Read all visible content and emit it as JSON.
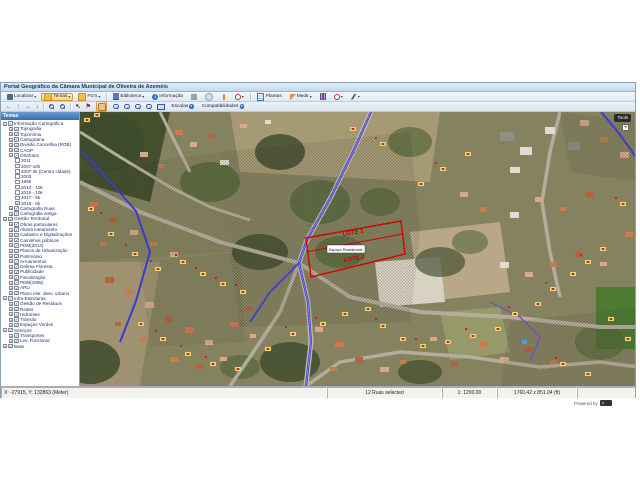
{
  "window": {
    "title": "Portal Geográfico da Câmara Municipal de Oliveira de Azeméis"
  },
  "colors": {
    "titlebar": "#c3d8ee",
    "active_button": "#ffd36e",
    "sidebar_header": "#3a6cb0",
    "parcel_red": "#d40000",
    "route_blue": "#3b3bd0",
    "address_box_yellow": "#f7e98a"
  },
  "toolbar_primary": {
    "items": [
      {
        "name": "localizar-button",
        "label": "Localizar",
        "icon": "binoculars",
        "arrow": true
      },
      {
        "name": "temas-button",
        "label": "Temas",
        "icon": "folder",
        "arrow": true,
        "active": true
      },
      {
        "name": "fgs-button",
        "label": "FG's",
        "icon": "folder",
        "arrow": true
      },
      {
        "name": "sep"
      },
      {
        "name": "biblioteca-button",
        "label": "Biblioteca",
        "icon": "library",
        "arrow": true
      },
      {
        "name": "informacao-button",
        "label": "Informação",
        "icon": "info"
      },
      {
        "name": "print-button",
        "icon": "print"
      },
      {
        "name": "globe-button",
        "icon": "globe"
      },
      {
        "name": "marker-button",
        "icon": "marker"
      },
      {
        "name": "settings-button",
        "icon": "gear-red",
        "arrow": true
      },
      {
        "name": "sep"
      },
      {
        "name": "plantas-button",
        "label": "Plantas",
        "icon": "document"
      },
      {
        "name": "medir-button",
        "label": "Medir",
        "icon": "ruler",
        "arrow": true
      },
      {
        "name": "chart-button",
        "icon": "chart"
      },
      {
        "name": "target-button",
        "icon": "target",
        "arrow": true
      },
      {
        "name": "tools-button",
        "icon": "wrench",
        "arrow": true
      }
    ]
  },
  "toolbar_secondary": {
    "items": [
      {
        "name": "pan-left-button",
        "type": "arrow-left"
      },
      {
        "name": "pan-up-button",
        "type": "arrow-up"
      },
      {
        "name": "pan-right-button",
        "type": "arrow-right"
      },
      {
        "name": "pan-down-button",
        "type": "arrow-down"
      },
      {
        "name": "sep",
        "type": "sep"
      },
      {
        "name": "zoom-in-button",
        "type": "zoom-plus"
      },
      {
        "name": "zoom-out-button",
        "type": "zoom-minus"
      },
      {
        "name": "sep",
        "type": "sep"
      },
      {
        "name": "select-pointer-button",
        "type": "pointer"
      },
      {
        "name": "flag-button",
        "type": "flag"
      },
      {
        "name": "pan-hand-button",
        "type": "hand",
        "active": true
      },
      {
        "name": "zoom-window-button",
        "type": "zoom"
      },
      {
        "name": "zoom-selection-button",
        "type": "zoom"
      },
      {
        "name": "zoom-previous-button",
        "type": "zoom"
      },
      {
        "name": "zoom-next-button",
        "type": "zoom"
      },
      {
        "name": "full-extent-button",
        "type": "extent"
      },
      {
        "name": "escalas-button",
        "type": "btn",
        "label": "Escalas"
      },
      {
        "name": "compatibilidades-button",
        "type": "btn",
        "label": "Compatibilidades"
      }
    ]
  },
  "sidebar": {
    "header": "Temas",
    "items": [
      {
        "l": "Informação Cartográfica",
        "d": 0,
        "e": "-",
        "c": true
      },
      {
        "l": "Topografia",
        "d": 1,
        "e": "+",
        "c": true
      },
      {
        "l": "Toponímia",
        "d": 1,
        "e": "+",
        "c": true
      },
      {
        "l": "Cartograma",
        "d": 1,
        "e": "+",
        "c": true
      },
      {
        "l": "Divisão Concelhia (ROB)",
        "d": 1,
        "e": "+",
        "c": true
      },
      {
        "l": "CAOP",
        "d": 1,
        "e": "+",
        "c": true
      },
      {
        "l": "Ortofotos",
        "d": 1,
        "e": "-",
        "c": true
      },
      {
        "l": "2011",
        "d": 2,
        "e": "",
        "c": false
      },
      {
        "l": "2007-10k",
        "d": 2,
        "e": "",
        "c": false
      },
      {
        "l": "2007-2k (Centro cidade)",
        "d": 2,
        "e": "",
        "c": false
      },
      {
        "l": "2003",
        "d": 2,
        "e": "",
        "c": false
      },
      {
        "l": "1995",
        "d": 2,
        "e": "",
        "c": false
      },
      {
        "l": "2012 - 10k",
        "d": 2,
        "e": "",
        "c": false
      },
      {
        "l": "2015 - 10k",
        "d": 2,
        "e": "",
        "c": false
      },
      {
        "l": "2017 - 5k",
        "d": 2,
        "e": "",
        "c": false
      },
      {
        "l": "2018 - 5k",
        "d": 2,
        "e": "",
        "c": true
      },
      {
        "l": "Cartografia Ruas",
        "d": 1,
        "e": "+",
        "c": true
      },
      {
        "l": "Cartografia antiga",
        "d": 1,
        "e": "+",
        "c": true
      },
      {
        "l": "Gestão Territorial",
        "d": 0,
        "e": "-",
        "c": true
      },
      {
        "l": "Obras particulares",
        "d": 1,
        "e": "+",
        "c": true
      },
      {
        "l": "Alvará loteamento",
        "d": 1,
        "e": "+",
        "c": true
      },
      {
        "l": "Cadastro e Digitalizações",
        "d": 1,
        "e": "+",
        "c": true
      },
      {
        "l": "Caminhos públicos",
        "d": 1,
        "e": "+",
        "c": true
      },
      {
        "l": "PDM(2013)",
        "d": 1,
        "e": "+",
        "c": true
      },
      {
        "l": "Planos de Urbanização",
        "d": 1,
        "e": "+",
        "c": true
      },
      {
        "l": "Património",
        "d": 1,
        "e": "+",
        "c": true
      },
      {
        "l": "Arruamentos",
        "d": 1,
        "e": "+",
        "c": true
      },
      {
        "l": "Defesa Floresta",
        "d": 1,
        "e": "+",
        "c": true
      },
      {
        "l": "Publicidade",
        "d": 1,
        "e": "+",
        "c": true
      },
      {
        "l": "Fiscalização",
        "d": 1,
        "e": "+",
        "c": true
      },
      {
        "l": "PDM(1995)",
        "d": 1,
        "e": "+",
        "c": true
      },
      {
        "l": "ARU",
        "d": 1,
        "e": "+",
        "c": true
      },
      {
        "l": "Plano estr. desv. urbano",
        "d": 1,
        "e": "+",
        "c": true
      },
      {
        "l": "Infra-Estruturas",
        "d": 0,
        "e": "-",
        "c": true
      },
      {
        "l": "Gestão de Resíduos",
        "d": 1,
        "e": "+",
        "c": true
      },
      {
        "l": "Redes",
        "d": 1,
        "e": "+",
        "c": true
      },
      {
        "l": "Hidrantes",
        "d": 1,
        "e": "+",
        "c": true
      },
      {
        "l": "Trânsito",
        "d": 1,
        "e": "+",
        "c": true
      },
      {
        "l": "Espaços Verdes",
        "d": 1,
        "e": "+",
        "c": true
      },
      {
        "l": "Serviços",
        "d": 0,
        "e": "-",
        "c": true
      },
      {
        "l": "Transportes",
        "d": 1,
        "e": "+",
        "c": true
      },
      {
        "l": "Lev. Funcional",
        "d": 1,
        "e": "+",
        "c": true
      },
      {
        "l": "Base",
        "d": 0,
        "e": "+",
        "c": true
      }
    ]
  },
  "map": {
    "tools_chip": "Tools",
    "zoom_plus": "+",
    "parcel": {
      "lote1": "LOTE 1",
      "lote2": "LOTE 2",
      "zone_label": "Espaço Residencial"
    }
  },
  "status_bar": {
    "coords": "X: -27915, Y: 132863 (Meter)",
    "selection": "12 Ruas selected",
    "scale": "1: 1200.00",
    "extent": "1760.42 x 851.04 (ft)"
  },
  "footer": {
    "powered_by": "Powered by"
  }
}
